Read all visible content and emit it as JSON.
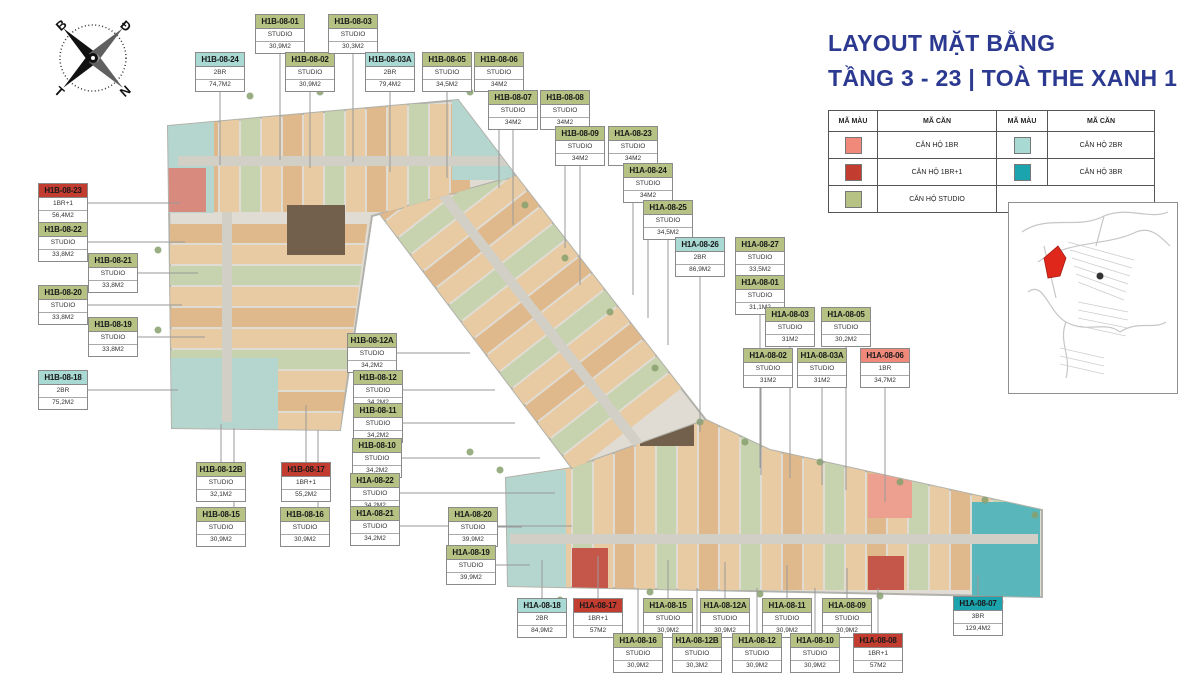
{
  "title": {
    "line1": "LAYOUT MẶT BẰNG",
    "line2": "TẦNG 3 - 23 | TOÀ THE XANH 1"
  },
  "compass": {
    "top_left": "B",
    "top_right": "Đ",
    "bottom_left": "T",
    "bottom_right": "N"
  },
  "legend": {
    "color_header": "MÃ MÀU",
    "unit_header": "MÃ CĂN",
    "rows": [
      [
        {
          "label": "CĂN HỘ 1BR",
          "type": "1BR"
        },
        {
          "label": "CĂN HỘ 2BR",
          "type": "2BR"
        }
      ],
      [
        {
          "label": "CĂN HỘ 1BR+1",
          "type": "1BR+1"
        },
        {
          "label": "CĂN HỘ 3BR",
          "type": "3BR"
        }
      ],
      [
        {
          "label": "CĂN HỘ STUDIO",
          "type": "STUDIO"
        },
        null
      ]
    ]
  },
  "type_colors": {
    "STUDIO": "#b6c283",
    "1BR": "#f0897a",
    "1BR+1": "#c23c30",
    "2BR": "#a8d9d2",
    "3BR": "#1ba3ae"
  },
  "units": [
    {
      "id": "H1B-08-24",
      "type": "2BR",
      "area": "74,7M2",
      "x": 195,
      "y": 52,
      "lead": "down",
      "to": 165
    },
    {
      "id": "H1B-08-01",
      "type": "STUDIO",
      "area": "30,9M2",
      "x": 255,
      "y": 14,
      "lead": "down",
      "to": 160
    },
    {
      "id": "H1B-08-02",
      "type": "STUDIO",
      "area": "30,9M2",
      "x": 285,
      "y": 52,
      "lead": "down",
      "to": 168
    },
    {
      "id": "H1B-08-03",
      "type": "STUDIO",
      "area": "30,3M2",
      "x": 328,
      "y": 14,
      "lead": "down",
      "to": 162
    },
    {
      "id": "H1B-08-03A",
      "type": "2BR",
      "area": "79,4M2",
      "x": 365,
      "y": 52,
      "lead": "down",
      "to": 172
    },
    {
      "id": "H1B-08-05",
      "type": "STUDIO",
      "area": "34,5M2",
      "x": 422,
      "y": 52,
      "lead": "down",
      "to": 178
    },
    {
      "id": "H1B-08-06",
      "type": "STUDIO",
      "area": "34M2",
      "x": 474,
      "y": 52,
      "lead": "down",
      "to": 188
    },
    {
      "id": "H1B-08-07",
      "type": "STUDIO",
      "area": "34M2",
      "x": 488,
      "y": 90,
      "lead": "down",
      "to": 225
    },
    {
      "id": "H1B-08-08",
      "type": "STUDIO",
      "area": "34M2",
      "x": 540,
      "y": 90,
      "lead": "down",
      "to": 248
    },
    {
      "id": "H1B-08-09",
      "type": "STUDIO",
      "area": "34M2",
      "x": 555,
      "y": 126,
      "lead": "down",
      "to": 285
    },
    {
      "id": "H1A-08-23",
      "type": "STUDIO",
      "area": "34M2",
      "x": 608,
      "y": 126,
      "lead": "down",
      "to": 295
    },
    {
      "id": "H1A-08-24",
      "type": "STUDIO",
      "area": "34M2",
      "x": 623,
      "y": 163,
      "lead": "down",
      "to": 318
    },
    {
      "id": "H1A-08-25",
      "type": "STUDIO",
      "area": "34,5M2",
      "x": 643,
      "y": 200,
      "lead": "down",
      "to": 345
    },
    {
      "id": "H1A-08-26",
      "type": "2BR",
      "area": "86,9M2",
      "x": 675,
      "y": 237,
      "lead": "down",
      "to": 432
    },
    {
      "id": "H1A-08-27",
      "type": "STUDIO",
      "area": "33,5M2",
      "x": 735,
      "y": 237,
      "lead": "down",
      "to": 458
    },
    {
      "id": "H1A-08-01",
      "type": "STUDIO",
      "area": "31,1M2",
      "x": 735,
      "y": 275,
      "lead": "down",
      "to": 468
    },
    {
      "id": "H1A-08-03",
      "type": "STUDIO",
      "area": "31M2",
      "x": 765,
      "y": 307,
      "lead": "down",
      "to": 478
    },
    {
      "id": "H1A-08-05",
      "type": "STUDIO",
      "area": "30,2M2",
      "x": 821,
      "y": 307,
      "lead": "down",
      "to": 490
    },
    {
      "id": "H1A-08-02",
      "type": "STUDIO",
      "area": "31M2",
      "x": 743,
      "y": 348,
      "lead": "down",
      "to": 475,
      "ox": 18
    },
    {
      "id": "H1A-08-03A",
      "type": "STUDIO",
      "area": "31M2",
      "x": 797,
      "y": 348,
      "lead": "down",
      "to": 485
    },
    {
      "id": "H1A-08-06",
      "type": "1BR",
      "area": "34,7M2",
      "x": 860,
      "y": 348,
      "lead": "down",
      "to": 502
    },
    {
      "id": "H1B-08-23",
      "type": "1BR+1",
      "area": "56,4M2",
      "x": 38,
      "y": 183,
      "lead": "right",
      "to": 180
    },
    {
      "id": "H1B-08-22",
      "type": "STUDIO",
      "area": "33,8M2",
      "x": 38,
      "y": 222,
      "lead": "right",
      "to": 185
    },
    {
      "id": "H1B-08-21",
      "type": "STUDIO",
      "area": "33,8M2",
      "x": 88,
      "y": 253,
      "lead": "right",
      "to": 198
    },
    {
      "id": "H1B-08-20",
      "type": "STUDIO",
      "area": "33,8M2",
      "x": 38,
      "y": 285,
      "lead": "right",
      "to": 182
    },
    {
      "id": "H1B-08-19",
      "type": "STUDIO",
      "area": "33,8M2",
      "x": 88,
      "y": 317,
      "lead": "right",
      "to": 205
    },
    {
      "id": "H1B-08-18",
      "type": "2BR",
      "area": "75,2M2",
      "x": 38,
      "y": 370,
      "lead": "right",
      "to": 178
    },
    {
      "id": "H1B-08-12A",
      "type": "STUDIO",
      "area": "34,2M2",
      "x": 347,
      "y": 333,
      "lead": "right",
      "to": 470
    },
    {
      "id": "H1B-08-12",
      "type": "STUDIO",
      "area": "34,2M2",
      "x": 353,
      "y": 370,
      "lead": "right",
      "to": 495
    },
    {
      "id": "H1B-08-11",
      "type": "STUDIO",
      "area": "34,2M2",
      "x": 353,
      "y": 403,
      "lead": "right",
      "to": 515
    },
    {
      "id": "H1B-08-10",
      "type": "STUDIO",
      "area": "34,2M2",
      "x": 352,
      "y": 438,
      "lead": "right",
      "to": 540
    },
    {
      "id": "H1B-08-12B",
      "type": "STUDIO",
      "area": "32,1M2",
      "x": 196,
      "y": 462,
      "lead": "up",
      "to": 424
    },
    {
      "id": "H1B-08-17",
      "type": "1BR+1",
      "area": "55,2M2",
      "x": 281,
      "y": 462,
      "lead": "up",
      "to": 405
    },
    {
      "id": "H1B-08-15",
      "type": "STUDIO",
      "area": "30,9M2",
      "x": 196,
      "y": 507,
      "lead": "up",
      "to": 428,
      "ox": 38
    },
    {
      "id": "H1B-08-16",
      "type": "STUDIO",
      "area": "30,9M2",
      "x": 280,
      "y": 507,
      "lead": "up",
      "to": 430,
      "ox": 38
    },
    {
      "id": "H1A-08-22",
      "type": "STUDIO",
      "area": "34,2M2",
      "x": 350,
      "y": 473,
      "lead": "right",
      "to": 555
    },
    {
      "id": "H1A-08-21",
      "type": "STUDIO",
      "area": "34,2M2",
      "x": 350,
      "y": 506,
      "lead": "right",
      "to": 572
    },
    {
      "id": "H1A-08-20",
      "type": "STUDIO",
      "area": "39,9M2",
      "x": 448,
      "y": 507,
      "lead": "right",
      "to": 522
    },
    {
      "id": "H1A-08-19",
      "type": "STUDIO",
      "area": "39,9M2",
      "x": 446,
      "y": 545,
      "lead": "right",
      "to": 530
    },
    {
      "id": "H1A-08-18",
      "type": "2BR",
      "area": "84,9M2",
      "x": 517,
      "y": 598,
      "lead": "up",
      "to": 560
    },
    {
      "id": "H1A-08-17",
      "type": "1BR+1",
      "area": "57M2",
      "x": 573,
      "y": 598,
      "lead": "up",
      "to": 556
    },
    {
      "id": "H1A-08-15",
      "type": "STUDIO",
      "area": "30,9M2",
      "x": 643,
      "y": 598,
      "lead": "up",
      "to": 560
    },
    {
      "id": "H1A-08-12A",
      "type": "STUDIO",
      "area": "30,9M2",
      "x": 700,
      "y": 598,
      "lead": "up",
      "to": 562
    },
    {
      "id": "H1A-08-11",
      "type": "STUDIO",
      "area": "30,9M2",
      "x": 762,
      "y": 598,
      "lead": "up",
      "to": 565
    },
    {
      "id": "H1A-08-09",
      "type": "STUDIO",
      "area": "30,9M2",
      "x": 822,
      "y": 598,
      "lead": "up",
      "to": 568
    },
    {
      "id": "H1A-08-07",
      "type": "3BR",
      "area": "129,4M2",
      "x": 953,
      "y": 596,
      "lead": "up",
      "to": 575
    },
    {
      "id": "H1A-08-16",
      "type": "STUDIO",
      "area": "30,9M2",
      "x": 613,
      "y": 633,
      "lead": "up",
      "to": 588
    },
    {
      "id": "H1A-08-12B",
      "type": "STUDIO",
      "area": "30,3M2",
      "x": 672,
      "y": 633,
      "lead": "up",
      "to": 588
    },
    {
      "id": "H1A-08-12",
      "type": "STUDIO",
      "area": "30,9M2",
      "x": 732,
      "y": 633,
      "lead": "up",
      "to": 588
    },
    {
      "id": "H1A-08-10",
      "type": "STUDIO",
      "area": "30,9M2",
      "x": 790,
      "y": 633,
      "lead": "up",
      "to": 588
    },
    {
      "id": "H1A-08-08",
      "type": "1BR+1",
      "area": "57M2",
      "x": 853,
      "y": 633,
      "lead": "up",
      "to": 588
    }
  ]
}
